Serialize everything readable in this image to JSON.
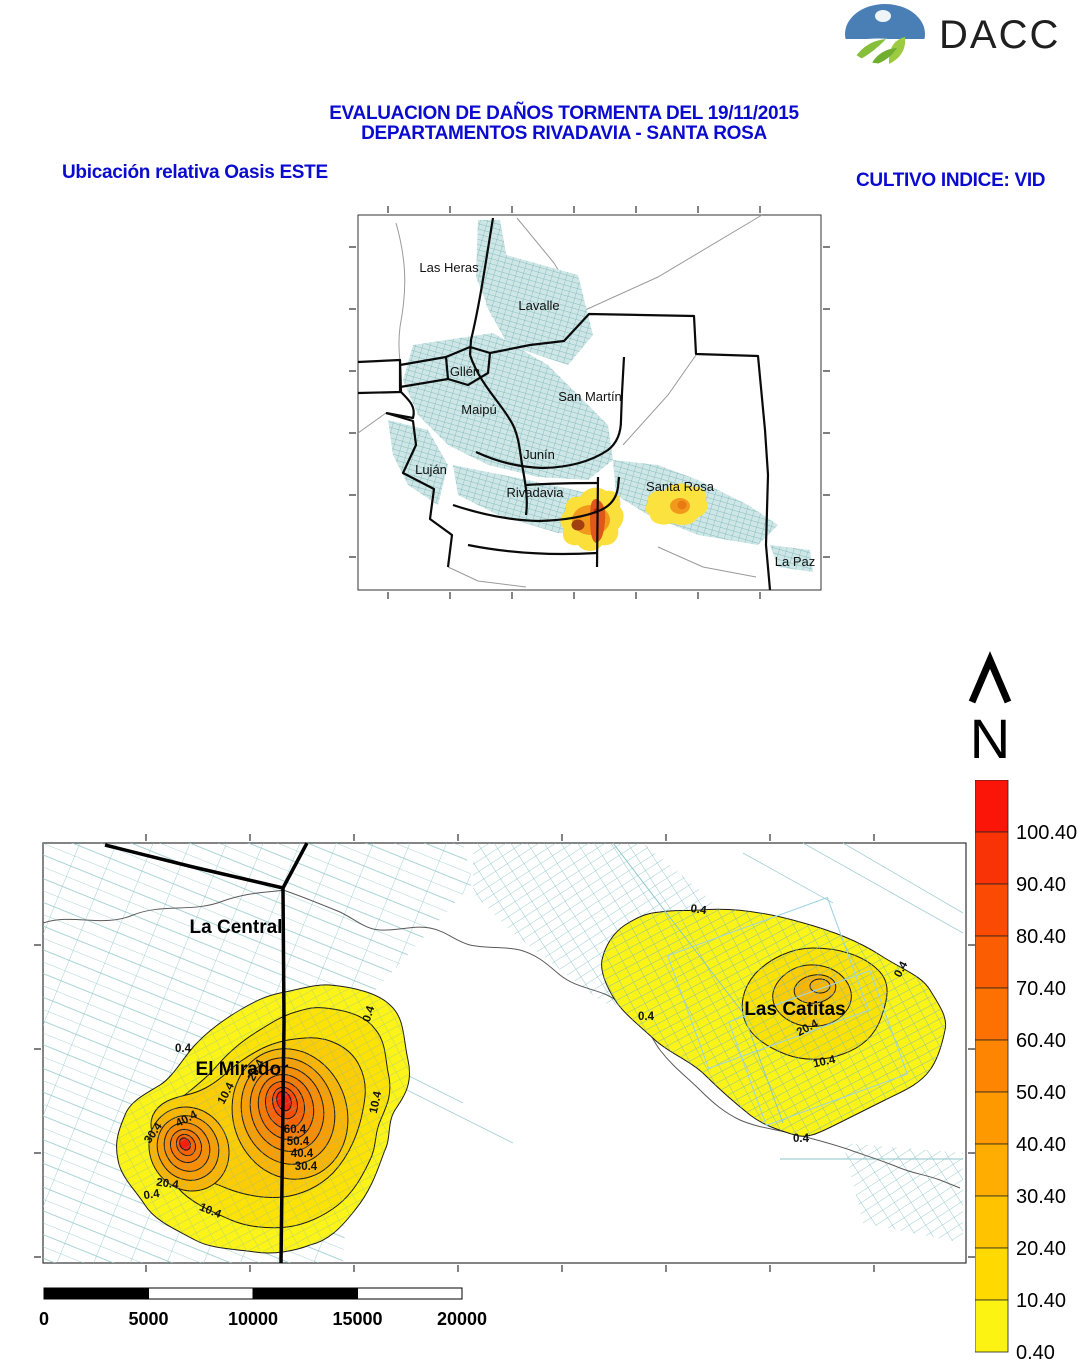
{
  "header": {
    "logo_text": "DACC",
    "title_line1": "EVALUACION DE DAÑOS TORMENTA DEL 19/11/2015",
    "title_line2": "DEPARTAMENTOS RIVADAVIA - SANTA ROSA",
    "subtitle_left": "Ubicación relativa Oasis ESTE",
    "subtitle_right": "CULTIVO INDICE: VID",
    "title_color": "#0b0bd0"
  },
  "overview_map": {
    "departments": [
      "Las Heras",
      "Lavalle",
      "Gllén",
      "Maipú",
      "San Martín",
      "Junín",
      "Luján",
      "Rivadavia",
      "Santa Rosa",
      "La Paz"
    ]
  },
  "north": {
    "label": "N"
  },
  "main_map": {
    "places": {
      "la_central": "La Central",
      "el_mirador": "El Mirador",
      "las_catitas": "Las Catitas"
    },
    "contours": {
      "c0": "0.4",
      "c10": "10.4",
      "c20": "20.4",
      "c30": "30.4",
      "c40": "40.4",
      "c50": "50.4",
      "c60": "60.4"
    },
    "fills": {
      "f0": "#fcf318",
      "f10": "#fce205",
      "f20": "#fccd02",
      "f30": "#fbb501",
      "f40": "#fa9e00",
      "f50": "#f98c00",
      "f60": "#f87800",
      "f70": "#f86203",
      "f80": "#f74c05",
      "f90": "#f81e0c"
    },
    "parcel_color": "#8fc6c8"
  },
  "legend": {
    "values": [
      "100.40",
      "90.40",
      "80.40",
      "70.40",
      "60.40",
      "50.40",
      "40.40",
      "30.40",
      "20.40",
      "10.40",
      "0.40"
    ],
    "colors": [
      "#fb1408",
      "#f93306",
      "#fa4a04",
      "#fb5d03",
      "#fc7102",
      "#fd8501",
      "#fe9900",
      "#ffad00",
      "#ffc300",
      "#ffd900",
      "#fcf312"
    ]
  },
  "scalebar": {
    "labels": [
      "0",
      "5000",
      "10000",
      "15000",
      "20000"
    ]
  }
}
